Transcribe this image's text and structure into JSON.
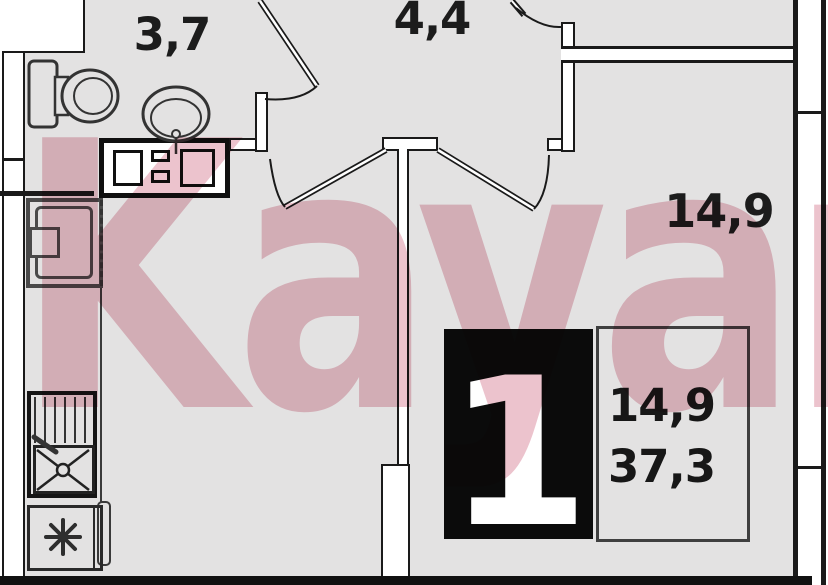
{
  "watermark": {
    "text": "Kayan",
    "color": "#ecc3cd"
  },
  "rooms": [
    {
      "id": "bathroom",
      "area_label": "3,7"
    },
    {
      "id": "hallway",
      "area_label": "4,4"
    },
    {
      "id": "living-room",
      "area_label": "14,9"
    }
  ],
  "info": {
    "room_count": "1",
    "living_area": "14,9",
    "total_area": "37,3"
  },
  "fixtures": [
    "toilet-icon",
    "washbasin-icon",
    "washer-counter-icon",
    "stove-icon",
    "kitchen-sink-icon",
    "fridge-icon"
  ],
  "colors": {
    "floor": "#e3e2e2",
    "wall_line": "#1a1a1a",
    "badge_bg": "#0b0b0b",
    "badge_text": "#ffffff",
    "watermark_pink": "#ecc3cd"
  }
}
